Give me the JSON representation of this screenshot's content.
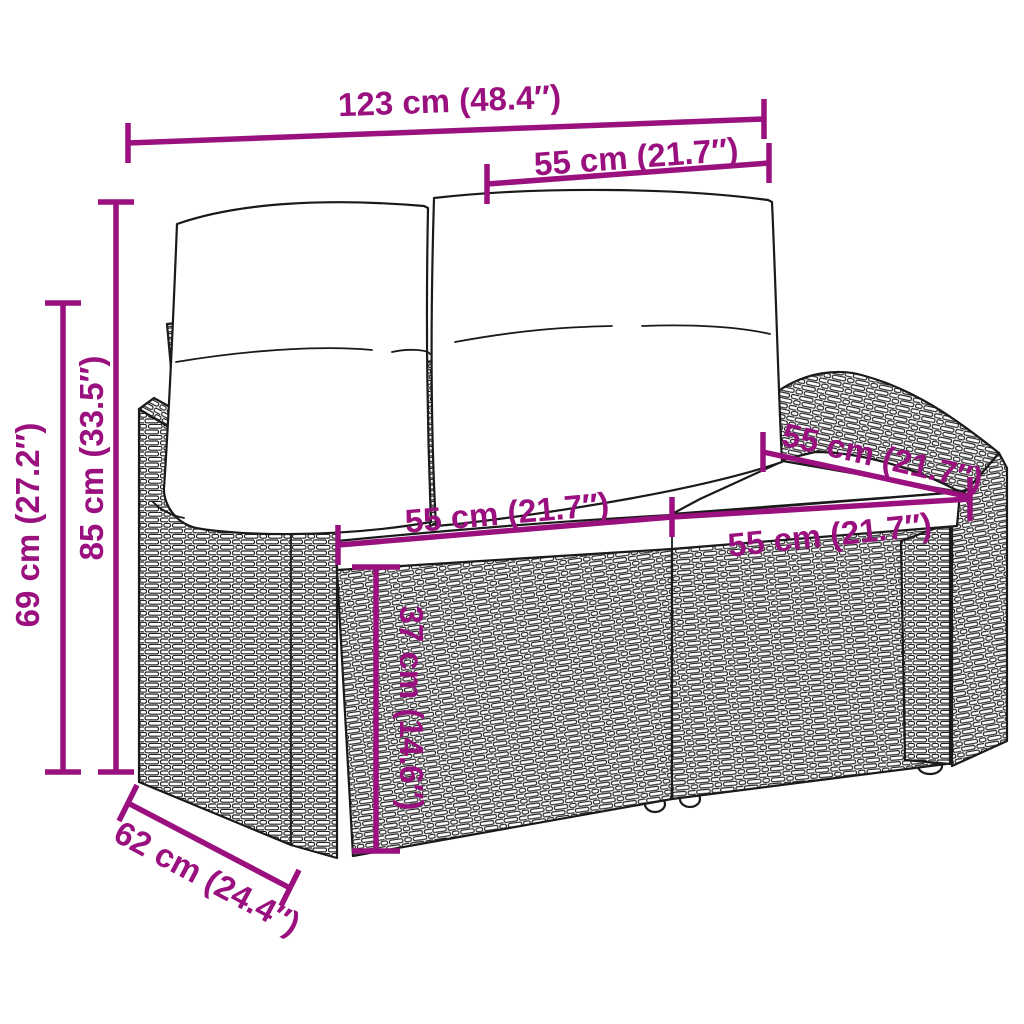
{
  "diagram": {
    "figure": "Line drawing of a two-seat rattan garden sofa with two back cushions and two seat cushions, annotated with dimension lines",
    "colors": {
      "accent": "#9a107e",
      "outline": "#1a1a1a",
      "background": "#ffffff"
    },
    "dimensions": {
      "overall_width": "123 cm (48.4″)",
      "backrest_width": "55 cm (21.7″)",
      "overall_height": "85 cm (33.5″)",
      "armrest_height": "69 cm (27.2″)",
      "seat_width_left": "55 cm (21.7″)",
      "seat_width_right": "55 cm (21.7″)",
      "seat_depth": "55 cm (21.7″)",
      "seat_height": "37 cm (14.6″)",
      "overall_depth": "62 cm (24.4″)"
    }
  }
}
